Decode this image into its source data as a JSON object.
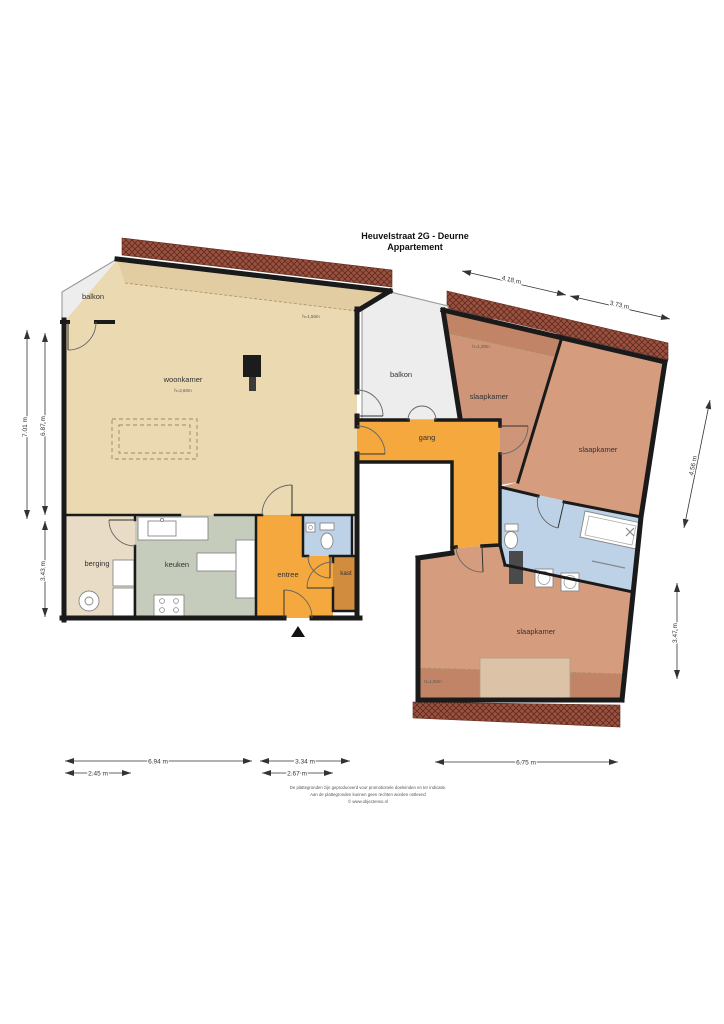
{
  "title": {
    "line1": "Heuvelstraat 2G - Deurne",
    "line2": "Appartement"
  },
  "rooms": {
    "balkon_left": "balkon",
    "woonkamer": "woonkamer",
    "woonkamer_note": "h=2,60m",
    "balkon_mid": "balkon",
    "gang": "gang",
    "berging": "berging",
    "keuken": "keuken",
    "entree": "entree",
    "kast": "kast",
    "slaapkamer_top": "slaapkamer",
    "slaapkamer_right": "slaapkamer",
    "slaapkamer_bottom": "slaapkamer"
  },
  "height_notes": {
    "woonkamer_edge": "h=1,50m",
    "slaapkamer_top_edge": "h=1,20m",
    "slaapkamer_bottom_edge": "h=1,50m"
  },
  "dimensions": {
    "top_left_width": "4.18 m",
    "top_right_width": "3.73 m",
    "left_outer_height": "7.01 m",
    "left_inner_height": "6.87 m",
    "left_lower_height": "3.43 m",
    "right_upper_height": "4.56 m",
    "right_lower_height": "3.47 m",
    "bottom_kitchen_width": "6.94 m",
    "bottom_berging_width": "2.45 m",
    "bottom_entree_outer_width": "3.34 m",
    "bottom_entree_width": "2.67 m",
    "bottom_right_width": "6.75 m"
  },
  "footer": {
    "line1": "De plattegronden zijn geproduceerd voor promotionele doeleinden en ter indicatie.",
    "line2": "Aan de plattegronden kunnen geen rechten worden ontleend",
    "line3": "© www.objectenso.nl"
  },
  "colors": {
    "wall": "#1a1a1a",
    "floor_living": "#ebd9b2",
    "floor_living_low": "#e2cda2",
    "floor_bedroom": "#d69c7e",
    "floor_bedroom_alt": "#cf9578",
    "floor_bedroom_low": "#c28467",
    "floor_hall": "#f4a83d",
    "floor_kitchen": "#c5ccbc",
    "floor_storage": "#e8dcc6",
    "floor_closet": "#d18c3e",
    "floor_bath": "#bdd2e6",
    "floor_balcony": "#ededed",
    "roof_base": "#9a5140",
    "roof_hatch": "#5f2b1f"
  }
}
